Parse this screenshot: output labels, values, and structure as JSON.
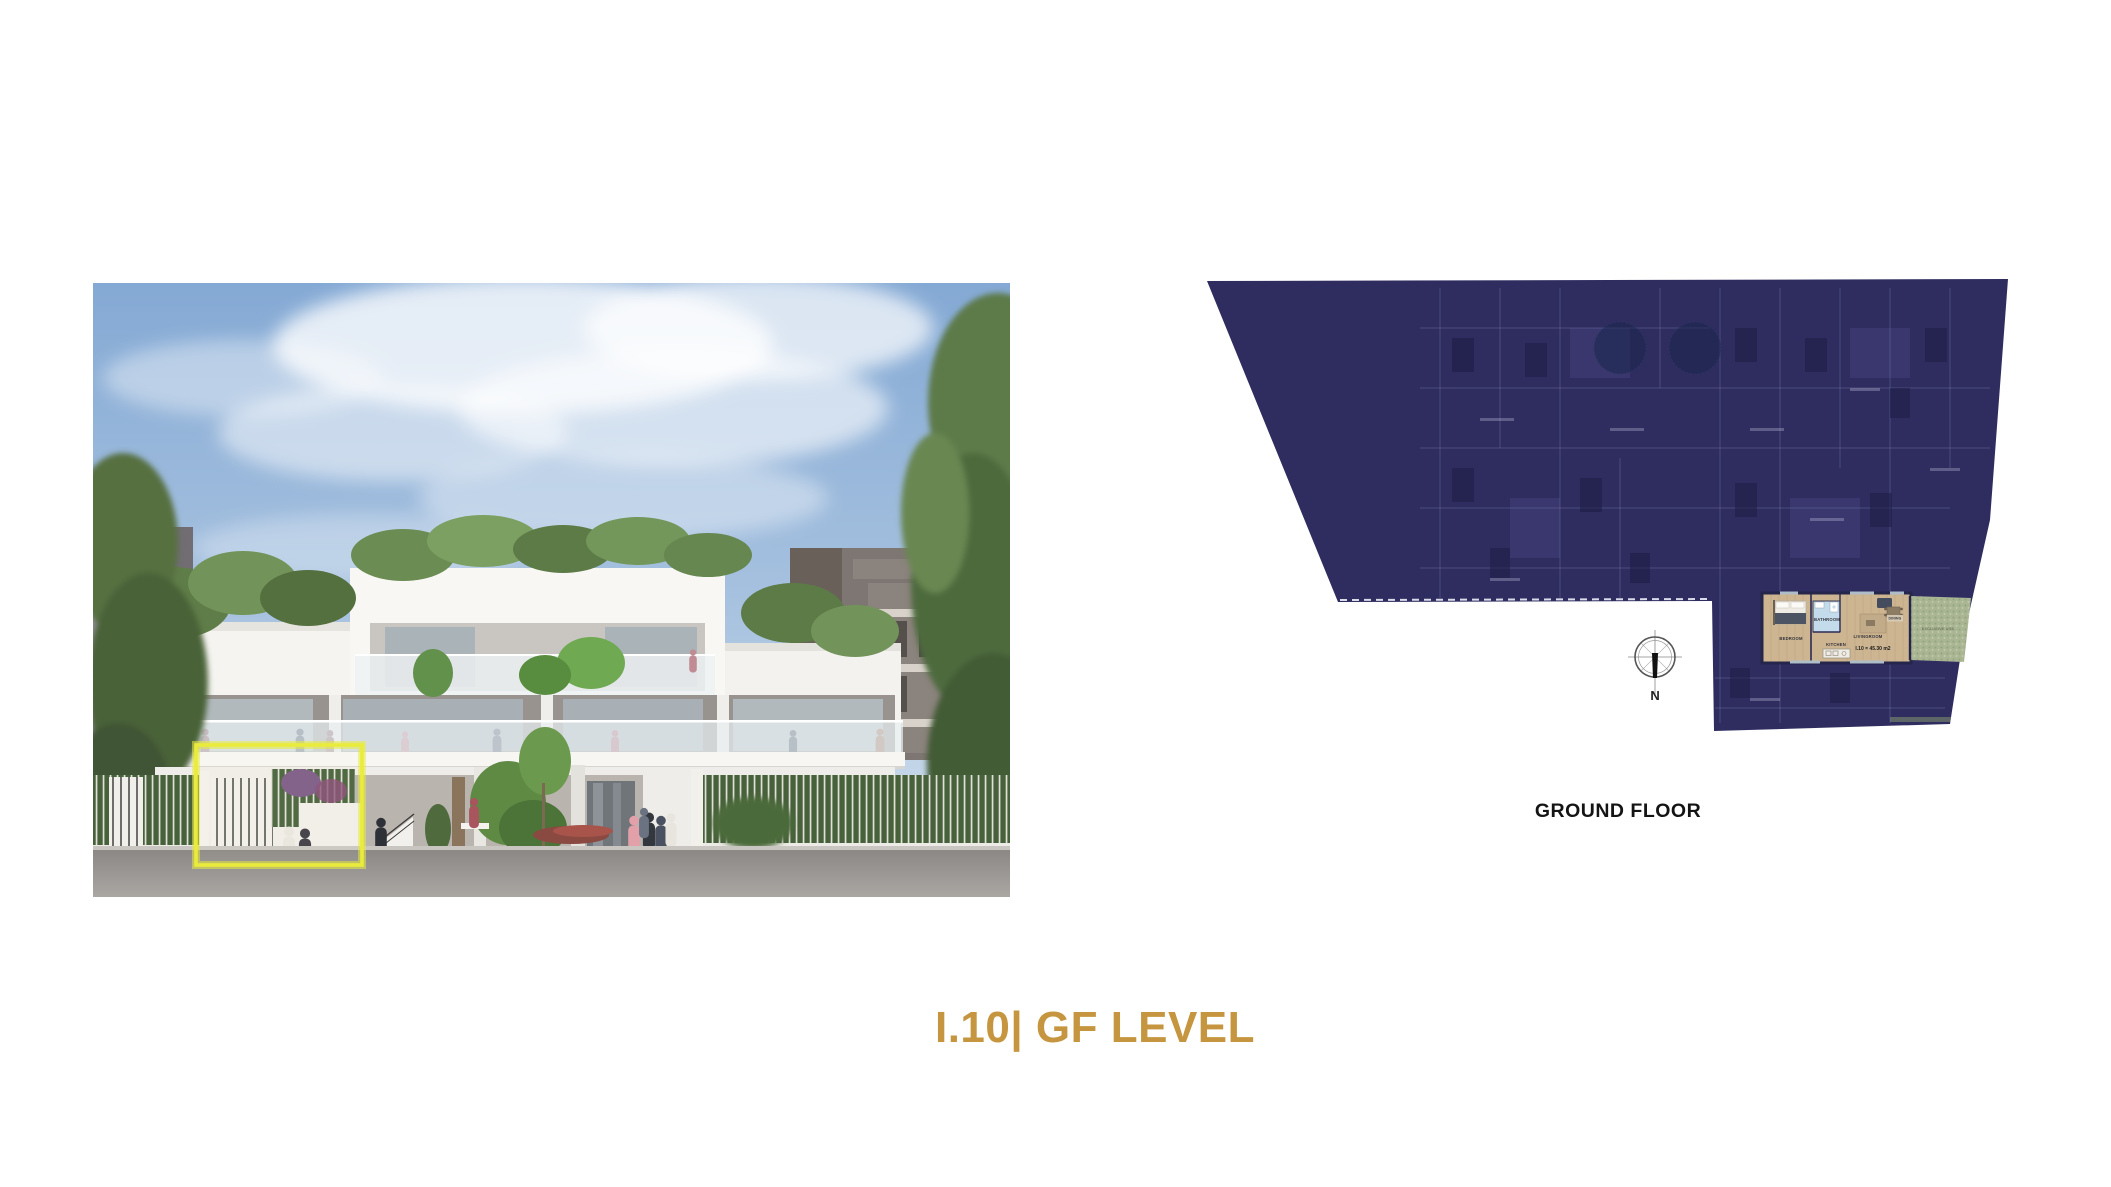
{
  "slide": {
    "title": "I.10| GF LEVEL",
    "title_color": "#C5963F",
    "background": "#FFFFFF"
  },
  "render": {
    "highlight_color": "#E9EC3C"
  },
  "floor_plan": {
    "caption": "GROUND FLOOR",
    "overlay_color": "#2F2D5F",
    "compass_label": "N",
    "unit": {
      "area_label": "I.10 = 45.30 m2",
      "bedroom_label": "BEDROOM",
      "bathroom_label": "BATHROOM",
      "kitchen_label": "KITCHEN",
      "livingroom_label": "LIVINGROOM",
      "dining_label": "DINING",
      "outdoor_label": "EXCLUSIVE USE"
    }
  }
}
